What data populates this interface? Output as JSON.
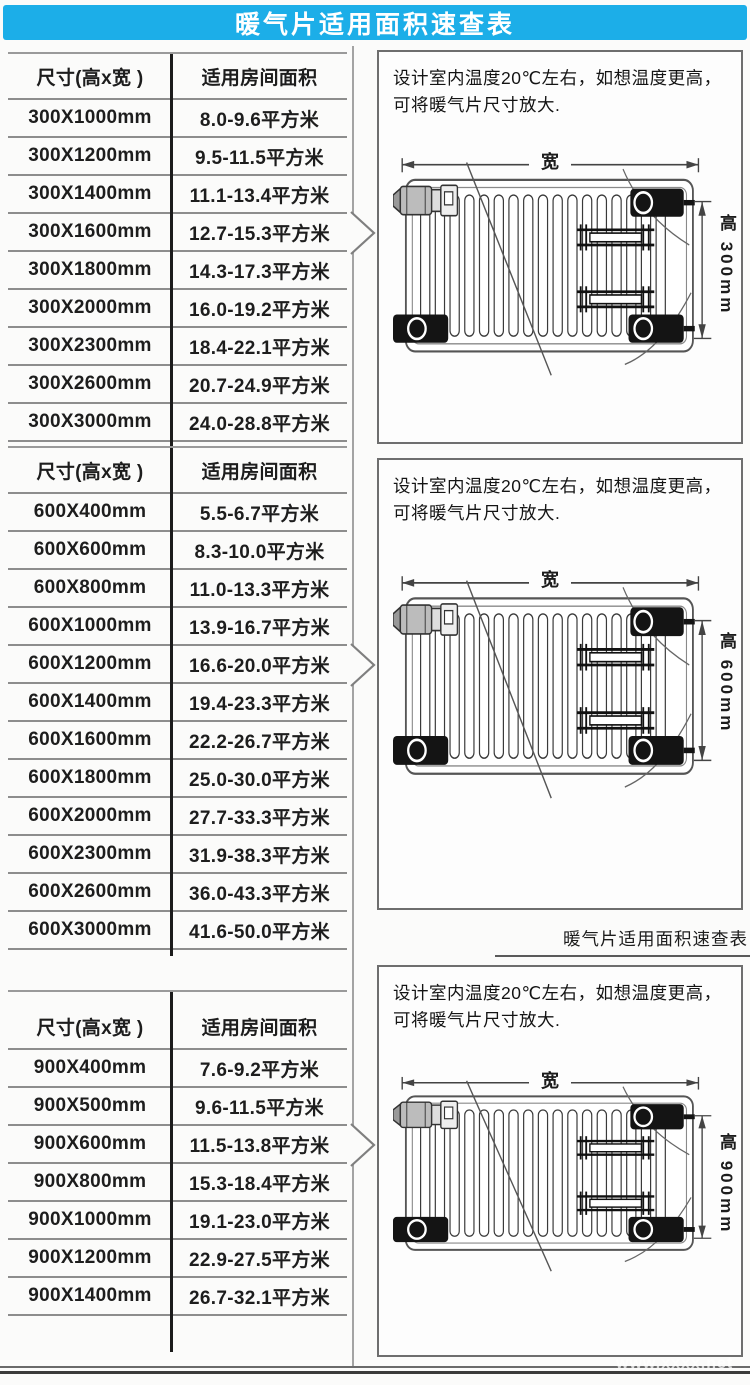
{
  "header": {
    "title": "暖气片适用面积速查表"
  },
  "tables": [
    {
      "columns": [
        "尺寸(高x宽 )",
        "适用房间面积"
      ],
      "rows": [
        [
          "300X1000mm",
          "8.0-9.6平方米"
        ],
        [
          "300X1200mm",
          "9.5-11.5平方米"
        ],
        [
          "300X1400mm",
          "11.1-13.4平方米"
        ],
        [
          "300X1600mm",
          "12.7-15.3平方米"
        ],
        [
          "300X1800mm",
          "14.3-17.3平方米"
        ],
        [
          "300X2000mm",
          "16.0-19.2平方米"
        ],
        [
          "300X2300mm",
          "18.4-22.1平方米"
        ],
        [
          "300X2600mm",
          "20.7-24.9平方米"
        ],
        [
          "300X3000mm",
          "24.0-28.8平方米"
        ]
      ],
      "arrow_row": 3
    },
    {
      "columns": [
        "尺寸(高x宽 )",
        "适用房间面积"
      ],
      "rows": [
        [
          "600X400mm",
          "5.5-6.7平方米"
        ],
        [
          "600X600mm",
          "8.3-10.0平方米"
        ],
        [
          "600X800mm",
          "11.0-13.3平方米"
        ],
        [
          "600X1000mm",
          "13.9-16.7平方米"
        ],
        [
          "600X1200mm",
          "16.6-20.0平方米"
        ],
        [
          "600X1400mm",
          "19.4-23.3平方米"
        ],
        [
          "600X1600mm",
          "22.2-26.7平方米"
        ],
        [
          "600X1800mm",
          "25.0-30.0平方米"
        ],
        [
          "600X2000mm",
          "27.7-33.3平方米"
        ],
        [
          "600X2300mm",
          "31.9-38.3平方米"
        ],
        [
          "600X2600mm",
          "36.0-43.3平方米"
        ],
        [
          "600X3000mm",
          "41.6-50.0平方米"
        ]
      ],
      "arrow_row": 4
    },
    {
      "columns": [
        "尺寸(高x宽 )",
        "适用房间面积"
      ],
      "rows": [
        [
          "900X400mm",
          "7.6-9.2平方米"
        ],
        [
          "900X500mm",
          "9.6-11.5平方米"
        ],
        [
          "900X600mm",
          "11.5-13.8平方米"
        ],
        [
          "900X800mm",
          "15.3-18.4平方米"
        ],
        [
          "900X1000mm",
          "19.1-23.0平方米"
        ],
        [
          "900X1200mm",
          "22.9-27.5平方米"
        ],
        [
          "900X1400mm",
          "26.7-32.1平方米"
        ]
      ],
      "arrow_row": 2
    }
  ],
  "panels": [
    {
      "note": "设计室内温度20℃左右，如想温度更高，可将暖气片尺寸放大.",
      "width_label": "宽",
      "height_label": "高 300mm"
    },
    {
      "note": "设计室内温度20℃左右，如想温度更高，可将暖气片尺寸放大.",
      "width_label": "宽",
      "height_label": "高 600mm"
    },
    {
      "note": "设计室内温度20℃左右，如想温度更高，可将暖气片尺寸放大.",
      "width_label": "宽",
      "height_label": "高 900mm"
    }
  ],
  "section_label": "暖气片适用面积速查表",
  "watermark": "www.xxxx.net",
  "colors": {
    "header_bg": "#1CAEE8",
    "row_line": "#8d8d8d",
    "column_divider": "#1b1b1b",
    "panel_border": "#6e6e6e"
  }
}
